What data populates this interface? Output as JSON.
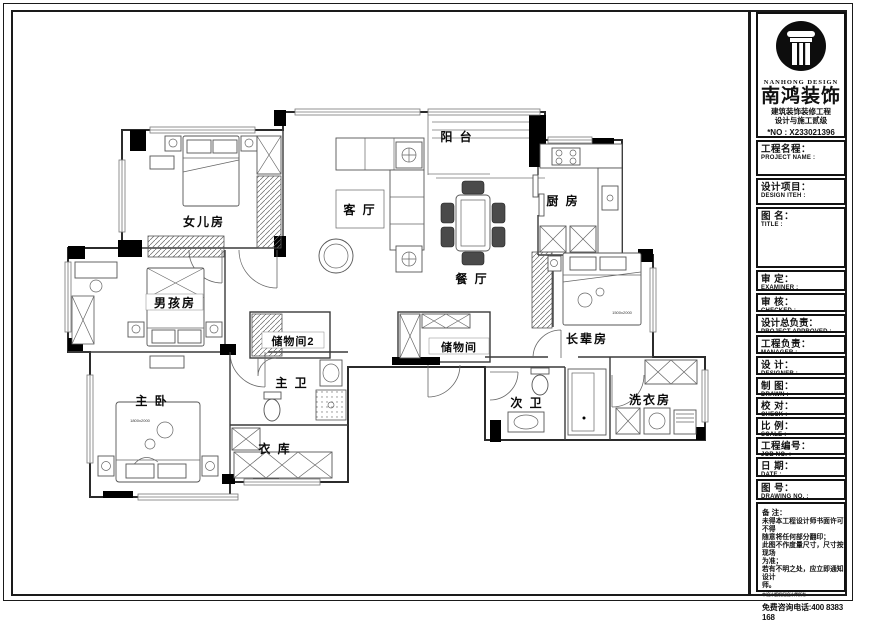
{
  "title_block": {
    "logo": {
      "brand_en": "NANHONG DESIGN",
      "brand_cn": "南鸿装饰",
      "line1": "建筑装饰装修工程",
      "line2": "设计与施工贰级",
      "license_no": "*NO : X233021396"
    },
    "fields": [
      {
        "cn": "工程名程：",
        "en": "PROJECT NAME :"
      },
      {
        "cn": "设计项目：",
        "en": "DESIGN ITEH :"
      },
      {
        "cn": "图 名：",
        "en": "TITLE :"
      },
      {
        "cn": "审 定：",
        "en": "EXAMINER :"
      },
      {
        "cn": "审 核：",
        "en": "CHECKED :"
      },
      {
        "cn": "设计总负责：",
        "en": "PROJECT APPROVED :"
      },
      {
        "cn": "工程负责：",
        "en": "MANAGER :"
      },
      {
        "cn": "设 计：",
        "en": "DESIGNER :"
      },
      {
        "cn": "制 图：",
        "en": "DRAWN :"
      },
      {
        "cn": "校 对：",
        "en": "CHECK :"
      },
      {
        "cn": "比 例：",
        "en": "SCALE :"
      },
      {
        "cn": "工程编号：",
        "en": "JOB NO. :"
      },
      {
        "cn": "日 期：",
        "en": "DATE :"
      },
      {
        "cn": "图 号：",
        "en": "DRAWING NO. :"
      }
    ],
    "notes": {
      "heading": "备 注：",
      "lines": [
        "未得本工程设计师书面许可不得",
        "随意将任何部分翻印；",
        "此图不作度量尺寸，尺寸按现场",
        "为准；",
        "若有不明之处，应立即通知设计",
        "师。"
      ],
      "fine_print": "本设计版权归设计师所有",
      "hotline": "免费咨询电话:400 8383 168"
    }
  },
  "plan": {
    "rooms": {
      "daughter_room": "女儿房",
      "boys_room": "男孩房",
      "master_bedroom": "主 卧",
      "cloak_room": "衣 库",
      "master_bath": "主 卫",
      "storage_2": "储物间2",
      "storage": "储物间",
      "living_room": "客 厅",
      "balcony": "阳 台",
      "dining_room": "餐 厅",
      "kitchen": "厨 房",
      "elders_room": "长辈房",
      "second_bath": "次 卫",
      "laundry_room": "洗衣房"
    },
    "bed_dimensions": {
      "master": "1800x2000",
      "elders": "1500x2000"
    }
  }
}
